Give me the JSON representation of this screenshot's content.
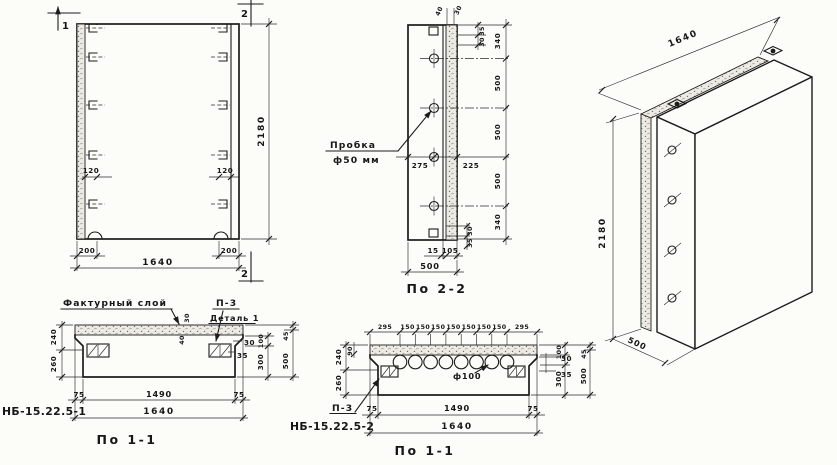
{
  "front_view": {
    "marker_top_left": "1",
    "marker_top_right": "2",
    "marker_bottom_right": "2",
    "dim_height": "2180",
    "dim_width": "1640",
    "dim_left_200": "200",
    "dim_right_200": "200",
    "dim_left_120": "120",
    "dim_right_120": "120"
  },
  "section22": {
    "title": "По 2-2",
    "callout_line1": "Пробка",
    "callout_line2": "ф50 мм",
    "top_dim_40": "40",
    "top_dim_30": "30",
    "side_top_35": "35",
    "side_top_30": "30",
    "right_dims": [
      "340",
      "500",
      "500",
      "500",
      "340"
    ],
    "dim_275": "275",
    "dim_225": "225",
    "side_bot_30": "30",
    "side_bot_35": "35",
    "bot_15": "15",
    "bot_105": "105",
    "dim_500": "500"
  },
  "iso": {
    "dim_length": "1640",
    "dim_height": "2180",
    "dim_depth": "500"
  },
  "sec11a": {
    "mark": "НБ-15.22.5-1",
    "title": "По 1-1",
    "factur_label": "Фактурный слой",
    "p3_label": "П-3",
    "detail_label": "Деталь 1",
    "dim_240": "240",
    "dim_260": "260",
    "dim_30v": "30",
    "dim_40v": "40",
    "edge_30": "30",
    "edge_35": "35",
    "col_100": "100",
    "col_300": "300",
    "col_45": "45",
    "col_500": "500",
    "bot_75l": "75",
    "bot_1490": "1490",
    "bot_75r": "75",
    "bot_1640": "1640"
  },
  "sec11b": {
    "mark": "НБ-15.22.5-2",
    "title": "По 1-1",
    "p3_label": "П-3",
    "hole_label": "ф100",
    "top_dims": [
      "295",
      "150",
      "150",
      "150",
      "150",
      "150",
      "150",
      "150",
      "295"
    ],
    "dim_240": "240",
    "dim_260": "260",
    "dim_90": "90",
    "edge_30": "30",
    "edge_35": "35",
    "col_100": "100",
    "col_300": "300",
    "col_45": "45",
    "col_500": "500",
    "bot_75l": "75",
    "bot_1490": "1490",
    "bot_75r": "75",
    "bot_1640": "1640"
  }
}
